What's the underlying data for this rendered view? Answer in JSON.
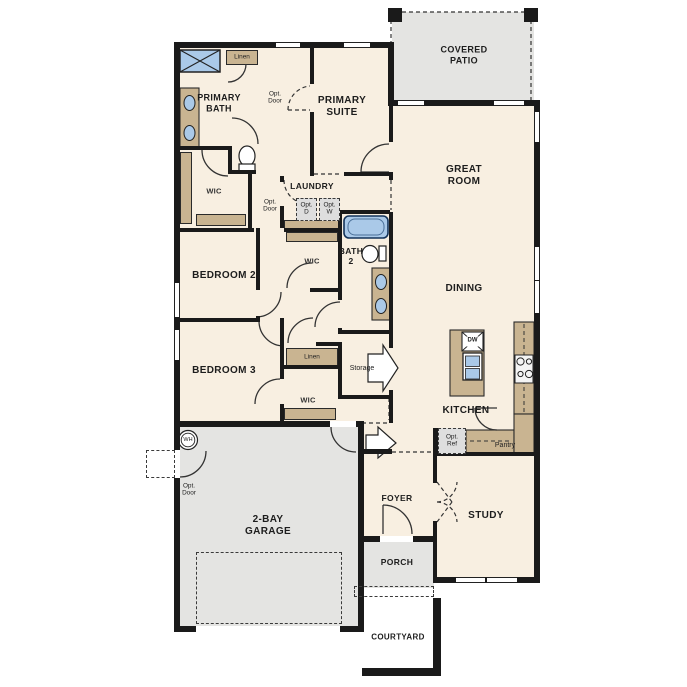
{
  "rooms": {
    "covered_patio": "COVERED\nPATIO",
    "primary_suite": "PRIMARY\nSUITE",
    "primary_bath": "PRIMARY\nBATH",
    "great_room": "GREAT\nROOM",
    "laundry": "LAUNDRY",
    "bath2": "BATH\n2",
    "bedroom2": "BEDROOM 2",
    "dining": "DINING",
    "bedroom3": "BEDROOM 3",
    "kitchen": "KITCHEN",
    "garage": "2-BAY\nGARAGE",
    "foyer": "FOYER",
    "study": "STUDY",
    "porch": "PORCH",
    "courtyard": "COURTYARD"
  },
  "closets": {
    "wic_primary": "WIC",
    "wic_bed2": "WIC",
    "wic_bed3": "WIC",
    "linen_upper": "Linen",
    "linen_hall": "Linen",
    "storage": "Storage",
    "pantry": "Pantry"
  },
  "options": {
    "opt_door_bath": "Opt.\nDoor",
    "opt_door_laundry": "Opt.\nDoor",
    "opt_door_garage": "Opt.\nDoor",
    "opt_dryer": "Opt.\nD",
    "opt_washer": "Opt.\nW",
    "opt_ref": "Opt.\nRef"
  },
  "fixtures": {
    "dishwasher": "DW",
    "water_heater": "WH"
  },
  "colors": {
    "floor": "#f8efe1",
    "outdoor": "#e4e4e2",
    "tan": "#c9b491",
    "fixture_blue": "#aac9e8",
    "wall": "#1a1a1a",
    "optbox": "#dedede"
  }
}
